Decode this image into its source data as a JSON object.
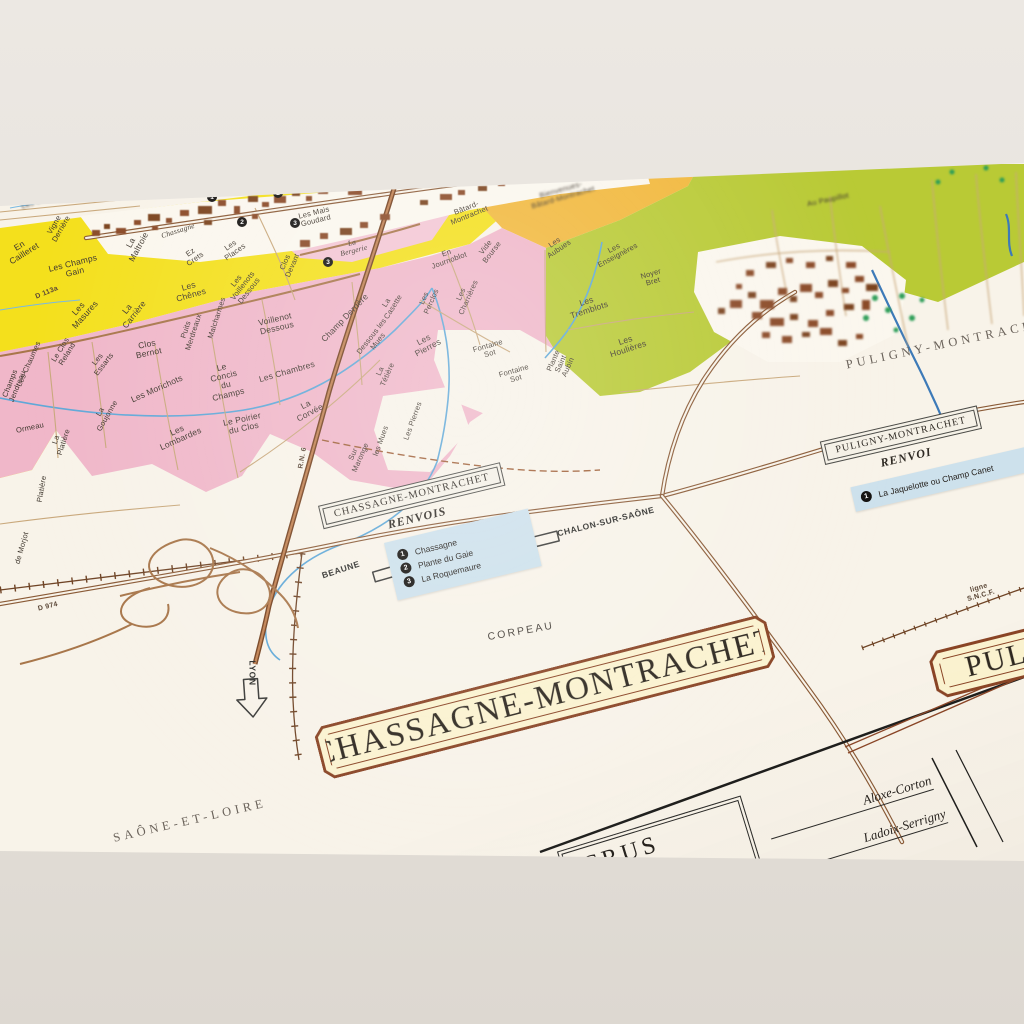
{
  "colors": {
    "paper": "#f8f3e9",
    "yellow": "#f4e01c",
    "pink": "#f0b7c9",
    "orange": "#f2b83c",
    "green": "#b9ca35",
    "villagePink": "#f4c6d4",
    "villageWhite": "#fbf7ee",
    "legendBlue": "#cde1ec",
    "bannerFill": "#fbf3d0",
    "bannerBorder": "#8a4526",
    "roadCase": "#8a5a36"
  },
  "banners": {
    "chassagne": "CHASSAGNE-MONTRACHET",
    "puligny_partial": "PULI"
  },
  "legend_chassagne": {
    "title": "CHASSAGNE-MONTRACHET",
    "subtitle": "RENVOIS",
    "items": [
      {
        "num": "1",
        "label": "Chassagne"
      },
      {
        "num": "2",
        "label": "Plante du Gaie"
      },
      {
        "num": "3",
        "label": "La Roquemaure"
      }
    ]
  },
  "legend_puligny": {
    "title": "PULIGNY-MONTRACHET",
    "subtitle": "RENVOI",
    "items": [
      {
        "num": "1",
        "label": "La Jaquelotte ou Champ Canet"
      }
    ]
  },
  "table": {
    "header": "CRUS",
    "rows": [
      {
        "t": "Aloxe-Corton",
        "x": 850,
        "y": 806,
        "w": 170,
        "r": -17
      },
      {
        "t": "Ladoix-Serrigny",
        "x": 862,
        "y": 840,
        "w": 175,
        "r": -17
      }
    ]
  },
  "markers": [
    {
      "n": "4",
      "x": 85,
      "y": 193
    },
    {
      "n": "1",
      "x": 212,
      "y": 197
    },
    {
      "n": "1",
      "x": 252,
      "y": 178
    },
    {
      "n": "2",
      "x": 278,
      "y": 193
    },
    {
      "n": "2",
      "x": 242,
      "y": 222
    },
    {
      "n": "3",
      "x": 295,
      "y": 223
    },
    {
      "n": "3",
      "x": 328,
      "y": 262
    }
  ],
  "labels": [
    {
      "t": "En\nCailleret",
      "x": 22,
      "y": 250,
      "r": -32
    },
    {
      "t": "Vigne\nDerrière",
      "x": 58,
      "y": 227,
      "r": -60,
      "c": "sm"
    },
    {
      "t": "Les Champs\nGain",
      "x": 74,
      "y": 268,
      "r": -14
    },
    {
      "t": "Chassagne",
      "x": 178,
      "y": 231,
      "r": -18,
      "c": "it sm"
    },
    {
      "t": "La\nMaltroie",
      "x": 135,
      "y": 245,
      "r": -62
    },
    {
      "t": "Ez\nCrets",
      "x": 193,
      "y": 256,
      "r": -35,
      "c": "sm"
    },
    {
      "t": "Les\nPlaces",
      "x": 233,
      "y": 249,
      "r": -35,
      "c": "sm"
    },
    {
      "t": "Les Mais\nGoudard",
      "x": 315,
      "y": 217,
      "r": -14,
      "c": "sm"
    },
    {
      "t": "La\nBergerie",
      "x": 353,
      "y": 247,
      "r": -14,
      "c": "it sm"
    },
    {
      "t": "Champs\nJendreau",
      "x": 14,
      "y": 385,
      "r": -68,
      "c": "sm"
    },
    {
      "t": "Les\nMasures",
      "x": 82,
      "y": 312,
      "r": -48
    },
    {
      "t": "La\nCarrière",
      "x": 131,
      "y": 312,
      "r": -52
    },
    {
      "t": "Les\nChênes",
      "x": 190,
      "y": 291,
      "r": -16
    },
    {
      "t": "Clos\nBernot",
      "x": 148,
      "y": 349,
      "r": -12
    },
    {
      "t": "Les Chaumes",
      "x": 29,
      "y": 364,
      "r": -66,
      "c": "sm"
    },
    {
      "t": "Le Clos\nReland",
      "x": 64,
      "y": 352,
      "r": -58,
      "c": "sm"
    },
    {
      "t": "Les\nEssarts",
      "x": 101,
      "y": 362,
      "r": -52,
      "c": "sm"
    },
    {
      "t": "Les Morichots",
      "x": 157,
      "y": 389,
      "r": -24
    },
    {
      "t": "Le\nConcis\ndu\nChamps",
      "x": 225,
      "y": 381,
      "r": -14
    },
    {
      "t": "Les\nLombardes",
      "x": 179,
      "y": 435,
      "r": -24
    },
    {
      "t": "La\nGoujonne",
      "x": 104,
      "y": 414,
      "r": -60,
      "c": "sm"
    },
    {
      "t": "Ormeau",
      "x": 30,
      "y": 428,
      "r": -12,
      "c": "sm"
    },
    {
      "t": "La\nPlatière",
      "x": 60,
      "y": 441,
      "r": -72,
      "c": "sm"
    },
    {
      "t": "Platière",
      "x": 42,
      "y": 489,
      "r": -80,
      "c": "sm"
    },
    {
      "t": "Le Poirier\ndu Clos",
      "x": 243,
      "y": 424,
      "r": -12
    },
    {
      "t": "La\nCorvée",
      "x": 308,
      "y": 409,
      "r": -28
    },
    {
      "t": "Les Chambres",
      "x": 287,
      "y": 372,
      "r": -16
    },
    {
      "t": "Voillenot\nDessous",
      "x": 276,
      "y": 324,
      "r": -13
    },
    {
      "t": "Les\nVoillenots\nDessous",
      "x": 243,
      "y": 286,
      "r": -52,
      "c": "sm"
    },
    {
      "t": "Malcharmes",
      "x": 217,
      "y": 318,
      "r": -72,
      "c": "sm"
    },
    {
      "t": "Puits\nMerdreaux",
      "x": 190,
      "y": 331,
      "r": -72,
      "c": "sm"
    },
    {
      "t": "Clos\nDevant",
      "x": 289,
      "y": 264,
      "r": -66,
      "c": "sm"
    },
    {
      "t": "Champ Derrière",
      "x": 345,
      "y": 318,
      "r": -46
    },
    {
      "t": "Dessous les\nMues",
      "x": 375,
      "y": 339,
      "r": -52,
      "c": "sm"
    },
    {
      "t": "La\nCasette",
      "x": 390,
      "y": 305,
      "r": -58,
      "c": "sm"
    },
    {
      "t": "La\nTétière",
      "x": 384,
      "y": 373,
      "r": -66,
      "c": "sm"
    },
    {
      "t": "Les\nPierres",
      "x": 426,
      "y": 344,
      "r": -28
    },
    {
      "t": "Les Pierres",
      "x": 413,
      "y": 421,
      "r": -70,
      "c": "sm"
    },
    {
      "t": "Sur\nMaronge",
      "x": 357,
      "y": 456,
      "r": -66,
      "c": "sm"
    },
    {
      "t": "les Mues",
      "x": 381,
      "y": 441,
      "r": -70,
      "c": "sm"
    },
    {
      "t": "Fontaine\nSot",
      "x": 489,
      "y": 350,
      "r": -16,
      "c": "sm"
    },
    {
      "t": "Fontaine\nSot",
      "x": 515,
      "y": 375,
      "r": -16,
      "c": "sm"
    },
    {
      "t": "Les\nPerclos",
      "x": 428,
      "y": 300,
      "r": -66,
      "c": "sm"
    },
    {
      "t": "Les\nCharrières",
      "x": 465,
      "y": 296,
      "r": -66,
      "c": "sm"
    },
    {
      "t": "En\nJournoblot",
      "x": 448,
      "y": 257,
      "r": -20,
      "c": "sm"
    },
    {
      "t": "Vide\nBourse",
      "x": 489,
      "y": 250,
      "r": -52,
      "c": "sm"
    },
    {
      "t": "Bâtard-\nMontrachet",
      "x": 468,
      "y": 212,
      "r": -22,
      "c": "sm"
    },
    {
      "t": "Bienvenues-\nBâtard-Montrachet",
      "x": 562,
      "y": 194,
      "r": -16,
      "c": "sm blur"
    },
    {
      "t": "Les\nAubues",
      "x": 557,
      "y": 246,
      "r": -34,
      "c": "sm"
    },
    {
      "t": "Les\nEnseignères",
      "x": 616,
      "y": 252,
      "r": -28,
      "c": "sm"
    },
    {
      "t": "Noyer\nBret",
      "x": 652,
      "y": 278,
      "r": -16,
      "c": "sm"
    },
    {
      "t": "Les\nTremblots",
      "x": 588,
      "y": 306,
      "r": -18
    },
    {
      "t": "Les\nHoulières",
      "x": 627,
      "y": 345,
      "r": -18
    },
    {
      "t": "Plante\nSaint\nAubin",
      "x": 561,
      "y": 364,
      "r": -66,
      "c": "sm"
    },
    {
      "t": "Au Paupillot",
      "x": 828,
      "y": 200,
      "r": -12,
      "c": "sm blur"
    },
    {
      "t": "Les Combards",
      "x": 46,
      "y": 199,
      "r": -18,
      "c": "sm blur"
    },
    {
      "t": "300",
      "x": 8,
      "y": 194,
      "r": -15,
      "c": "sm"
    },
    {
      "t": "de Morjot",
      "x": 22,
      "y": 548,
      "r": -74,
      "c": "sm"
    },
    {
      "t": "D 974",
      "x": 48,
      "y": 607,
      "r": -14,
      "c": "road"
    },
    {
      "t": "D 113a",
      "x": 47,
      "y": 293,
      "r": -22,
      "c": "road"
    },
    {
      "t": "R.N. 6",
      "x": 303,
      "y": 458,
      "r": -80,
      "c": "road"
    },
    {
      "t": "ligne  S.N.C.F.",
      "x": 980,
      "y": 592,
      "r": -16,
      "c": "road"
    },
    {
      "t": "CORPEAU",
      "x": 521,
      "y": 632,
      "r": -10,
      "c": "place"
    },
    {
      "t": "SAÔNE-ET-LOIRE",
      "x": 190,
      "y": 821,
      "r": -13,
      "c": "region"
    },
    {
      "t": "PULIGNY-MONTRACHET",
      "x": 952,
      "y": 343,
      "r": -12,
      "c": "region"
    },
    {
      "t": "BEAUNE",
      "x": 341,
      "y": 570,
      "r": -18,
      "c": "dir"
    },
    {
      "t": "CHALON-SUR-SAÔNE",
      "x": 606,
      "y": 522,
      "r": -14,
      "c": "dir"
    },
    {
      "t": "LYON",
      "x": 252,
      "y": 673,
      "r": 90,
      "c": "dir"
    }
  ]
}
